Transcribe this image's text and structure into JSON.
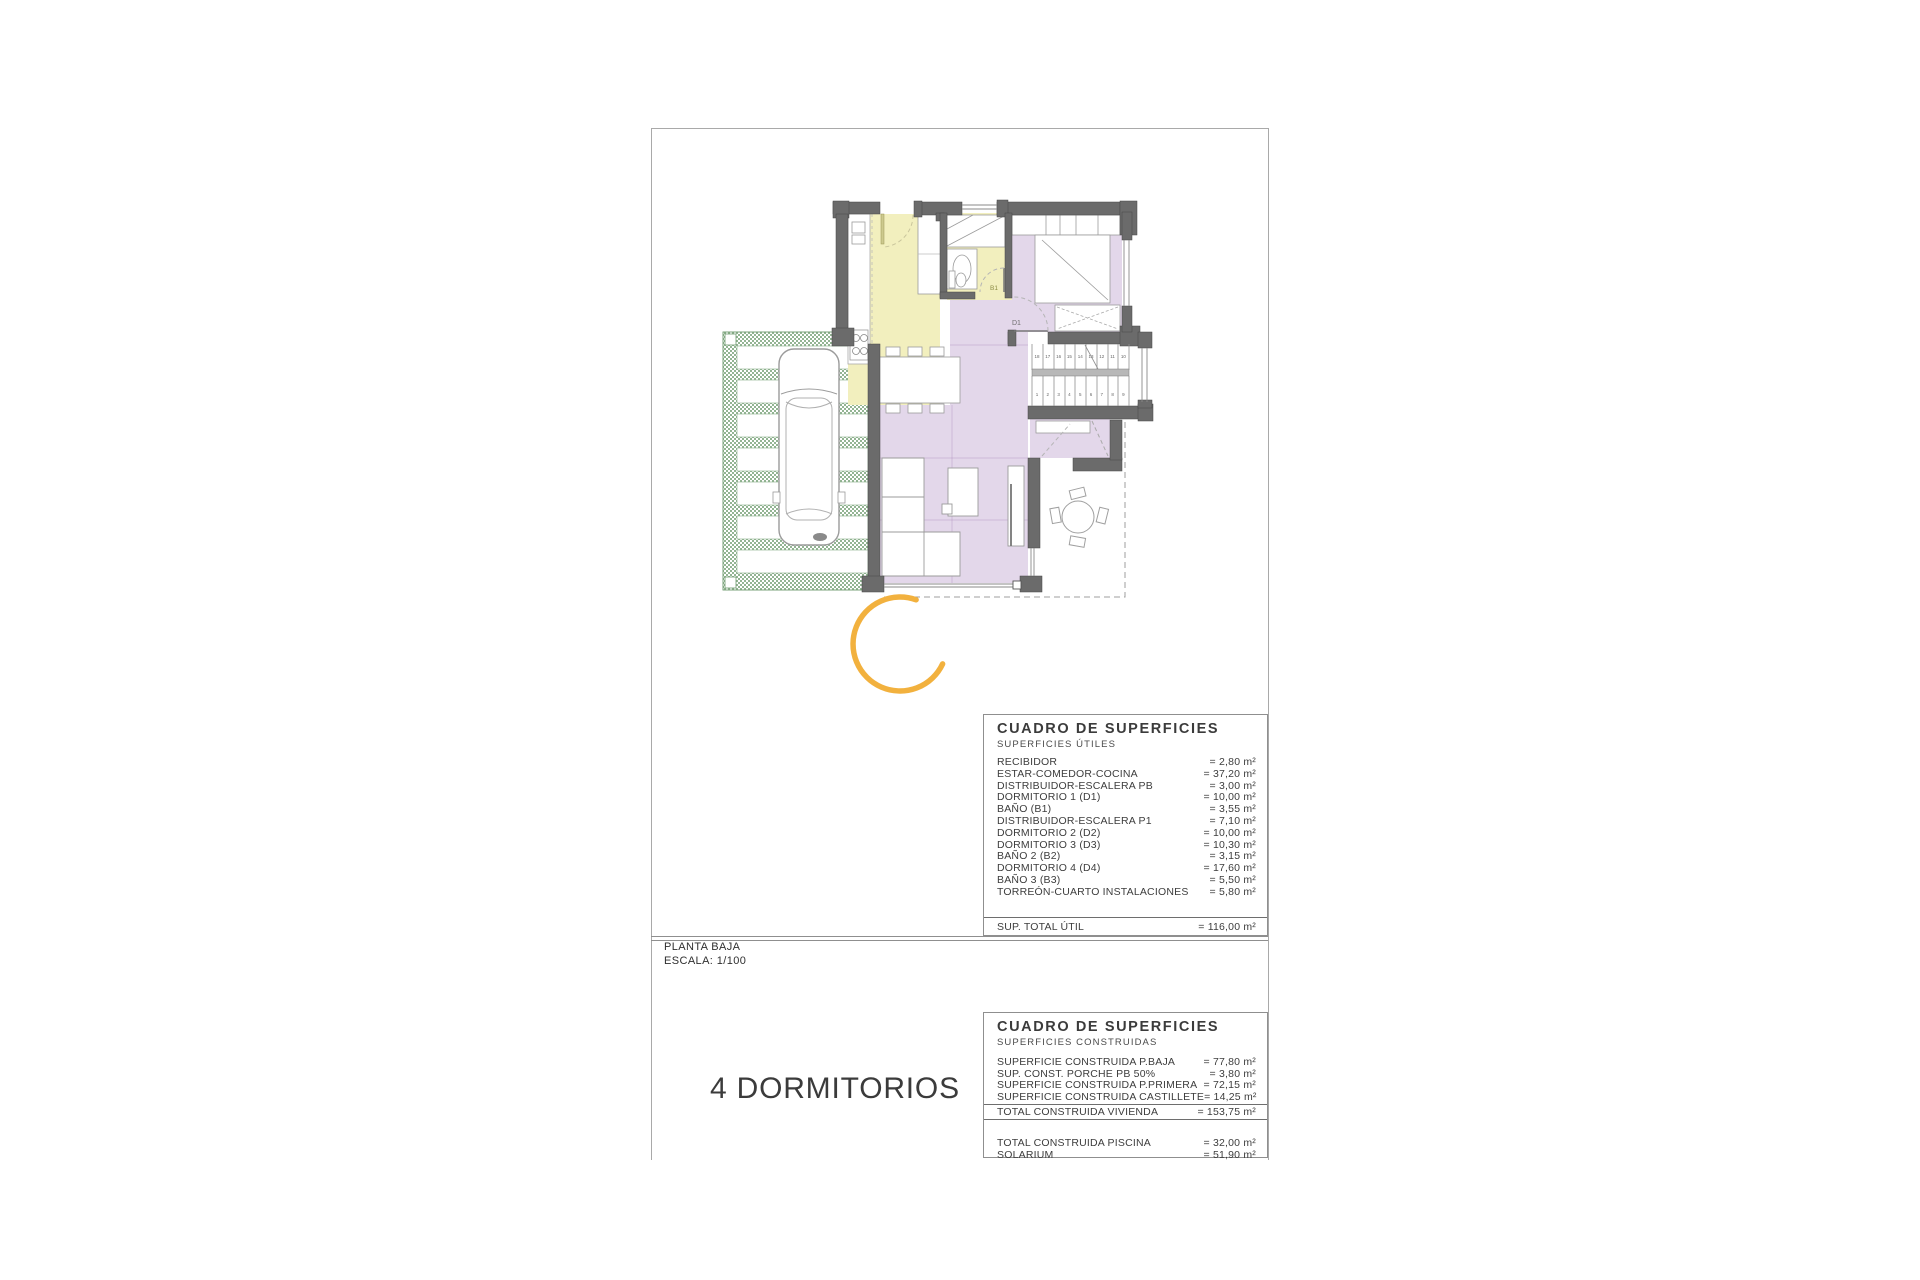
{
  "title_block": {
    "plan_name": "PLANTA BAJA",
    "scale": "ESCALA: 1/100",
    "summary": "4 DORMITORIOS"
  },
  "plan": {
    "labels": {
      "bath_door": "B1",
      "bedroom_door": "D1"
    },
    "stairs": {
      "upper_numbers": [
        "18",
        "17",
        "16",
        "15",
        "14",
        "13",
        "12",
        "11",
        "10"
      ],
      "lower_numbers": [
        "1",
        "2",
        "3",
        "4",
        "5",
        "6",
        "7",
        "8",
        "9"
      ]
    },
    "colors": {
      "room_yellow": "#F2EFBE",
      "room_purple": "#E3D7EA",
      "pergola_green": "#93B493",
      "wall_gray": "#6B6B6B",
      "accent_orange": "#F2B13E"
    }
  },
  "tables": [
    {
      "title": "CUADRO DE SUPERFICIES",
      "subtitle": "SUPERFICIES ÚTILES",
      "rows": [
        {
          "label": "RECIBIDOR",
          "value": "= 2,80 m²"
        },
        {
          "label": "ESTAR-COMEDOR-COCINA",
          "value": "= 37,20 m²"
        },
        {
          "label": "DISTRIBUIDOR-ESCALERA PB",
          "value": "= 3,00 m²"
        },
        {
          "label": "DORMITORIO 1 (D1)",
          "value": "= 10,00 m²"
        },
        {
          "label": "BAÑO  (B1)",
          "value": "= 3,55 m²"
        },
        {
          "label": "DISTRIBUIDOR-ESCALERA P1",
          "value": "= 7,10 m²"
        },
        {
          "label": "DORMITORIO 2 (D2)",
          "value": "= 10,00 m²"
        },
        {
          "label": "DORMITORIO 3 (D3)",
          "value": "= 10,30 m²"
        },
        {
          "label": "BAÑO 2 (B2)",
          "value": "= 3,15 m²"
        },
        {
          "label": "DORMITORIO 4 (D4)",
          "value": "= 17,60 m²"
        },
        {
          "label": "BAÑO 3 (B3)",
          "value": "= 5,50 m²"
        },
        {
          "label": "TORREÓN-CUARTO INSTALACIONES",
          "value": "= 5,80 m²"
        }
      ],
      "total": {
        "label": "SUP. TOTAL ÚTIL",
        "value": "= 116,00 m²"
      }
    },
    {
      "title": "CUADRO DE SUPERFICIES",
      "subtitle": "SUPERFICIES CONSTRUIDAS",
      "rows": [
        {
          "label": "SUPERFICIE  CONSTRUIDA P.BAJA",
          "value": "= 77,80 m²"
        },
        {
          "label": "SUP. CONST. PORCHE PB 50%",
          "value": "= 3,80 m²"
        },
        {
          "label": "SUPERFICIE CONSTRUIDA P.PRIMERA",
          "value": "= 72,15 m²"
        },
        {
          "label": "SUPERFICIE CONSTRUIDA CASTILLETE",
          "value": "= 14,25 m²"
        }
      ],
      "total": {
        "label": "TOTAL CONSTRUIDA VIVIENDA",
        "value": "= 153,75 m²"
      },
      "extra_rows": [
        {
          "label": "TOTAL CONSTRUIDA PISCINA",
          "value": "= 32,00 m²"
        },
        {
          "label": "SOLARIUM",
          "value": "= 51,90 m²"
        }
      ]
    }
  ]
}
